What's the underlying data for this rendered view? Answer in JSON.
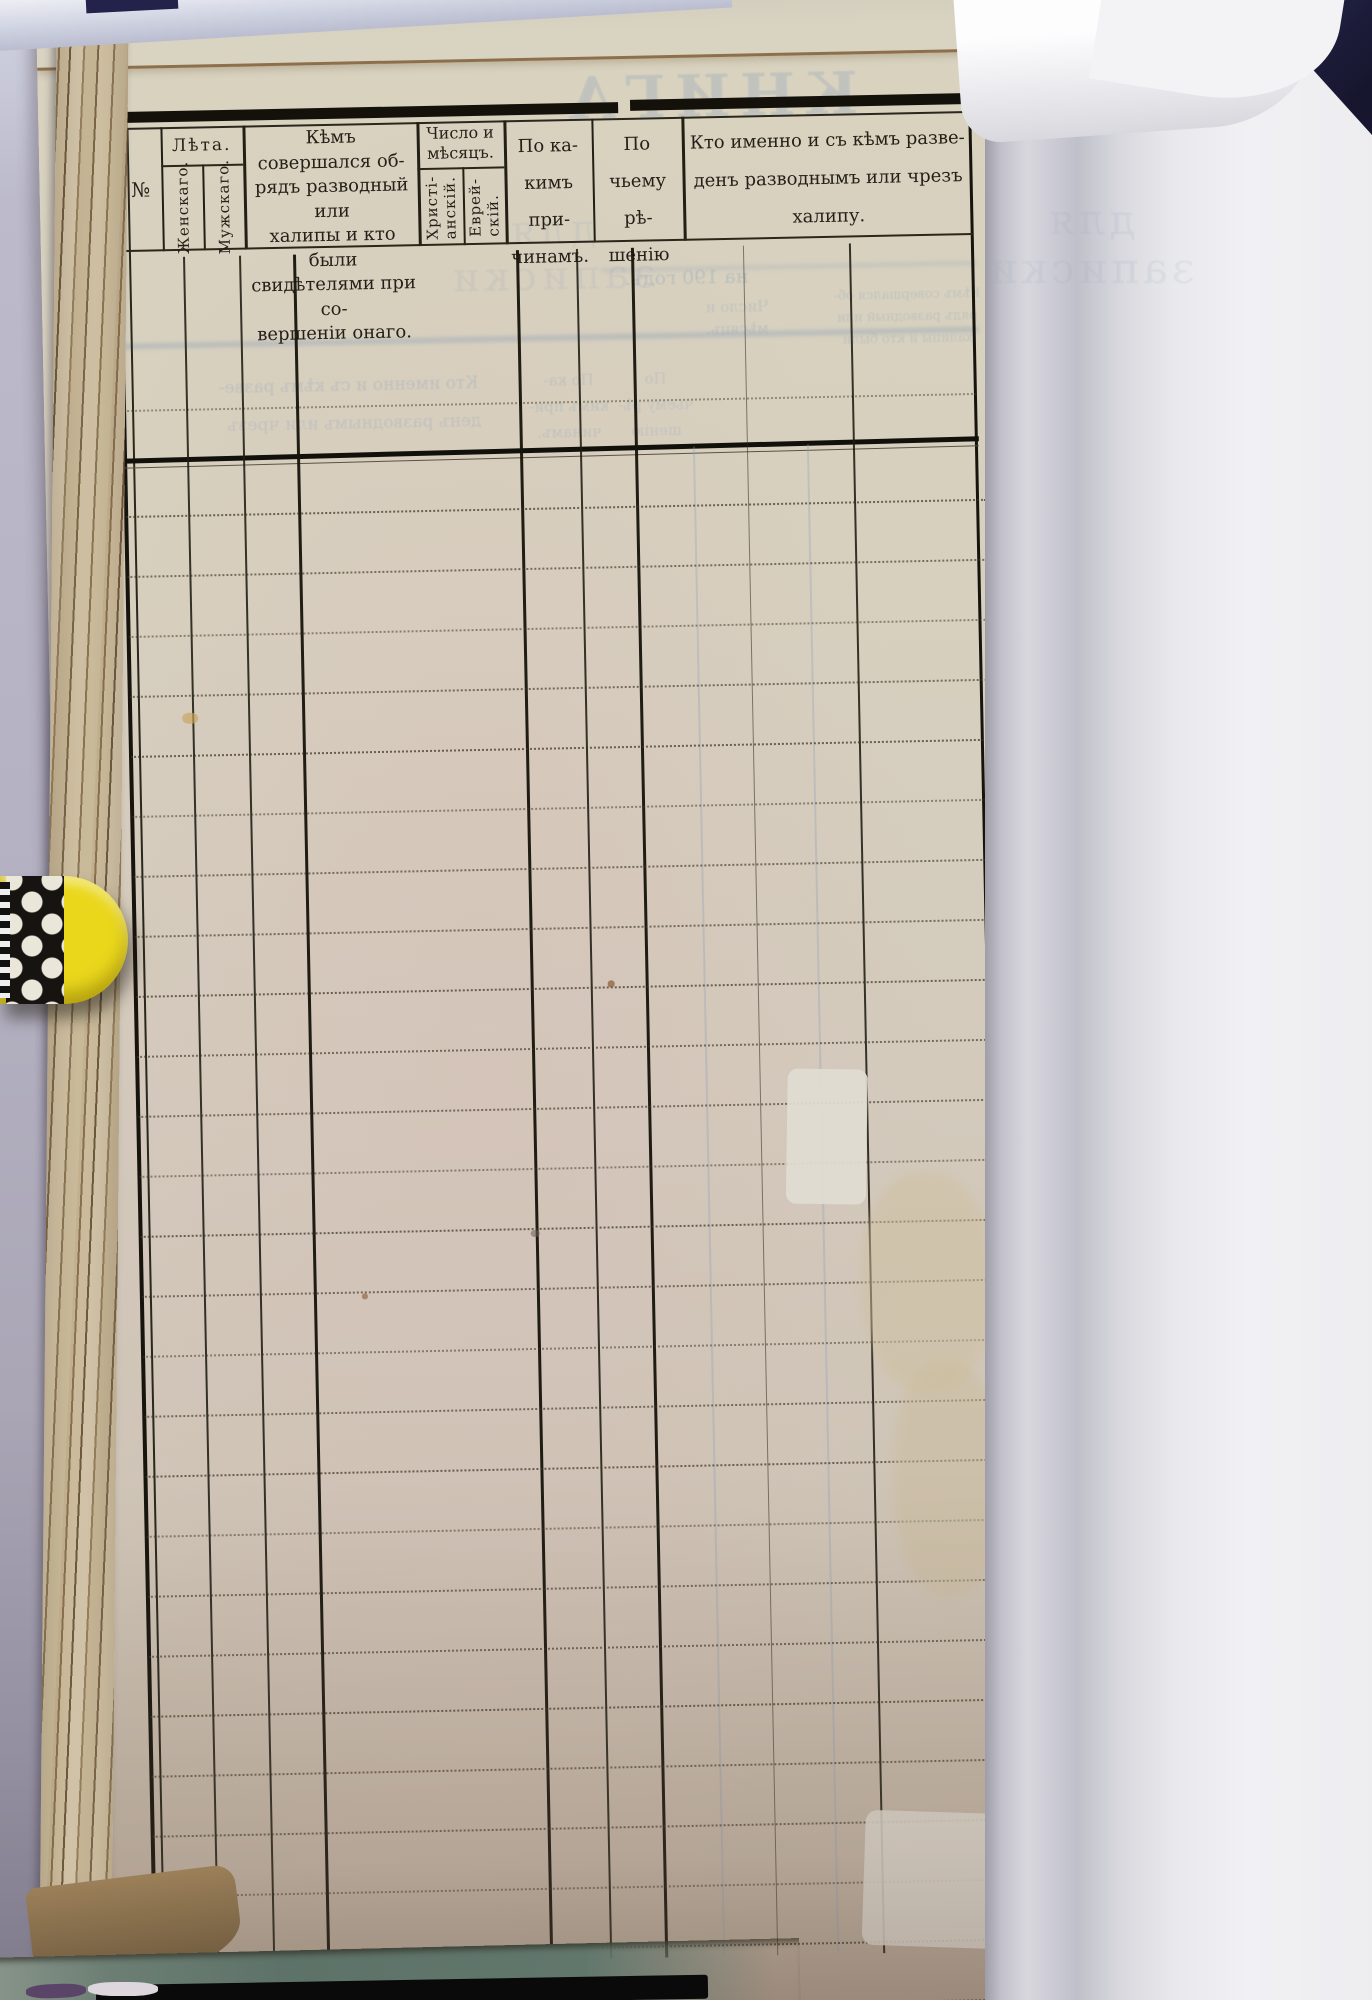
{
  "palette": {
    "paper": "#d6cfc0",
    "ink": "#241f17",
    "rule_black": "#17140d",
    "dotted_line": "#3a3321",
    "showthrough_blue": "#8fa3bb",
    "clip_yellow": "#ead71c",
    "backdrop_grey": "#b4b1c2",
    "facing_page_white": "#ededf0",
    "cover_navy": "#1d1d3c",
    "bottom_teal": "#5d7268"
  },
  "header": {
    "no": "№",
    "years_group": "Лѣта.",
    "years_female": "Женскаго.",
    "years_male": "Мужскаго.",
    "officiant": "Кѣмъ совершался об-\nрядъ разводный или\nхалипы и кто были\nсвидѣтелями при со-\nвершеніи онаго.",
    "date_group": "Число и\nмѣсяцъ.",
    "date_christian": "Христі-\nанскій.",
    "date_jewish": "Еврей-\nскій.",
    "reasons": "По ка-\nкимъ при-\nчинамъ.",
    "decision": "По\nчьему рѣ-\nшенію",
    "who": "Кто именно и съ кѣмъ разве-\nденъ разводнымъ или чрезъ\nхалипу."
  },
  "body": {
    "ruled_row_count": 26
  },
  "showthrough": {
    "book_title": "КНИГА",
    "book_subtitle": "для записки",
    "year_line": "на 190  годъ.",
    "frag_who_1": "Кто именно и съ кѣмъ разве-",
    "frag_who_2": "денъ разводнымъ или чрезъ",
    "frag_date": "Число и\nмѣсяцъ.",
    "frag_reasons": "По ка-\nкимъ при-\nчинамъ.",
    "frag_decision": "По\nчьему рѣ-\nшенію",
    "frag_officiant": "Кѣмъ совершался об-\nрядъ разводный или\nхалипы и кто были"
  }
}
